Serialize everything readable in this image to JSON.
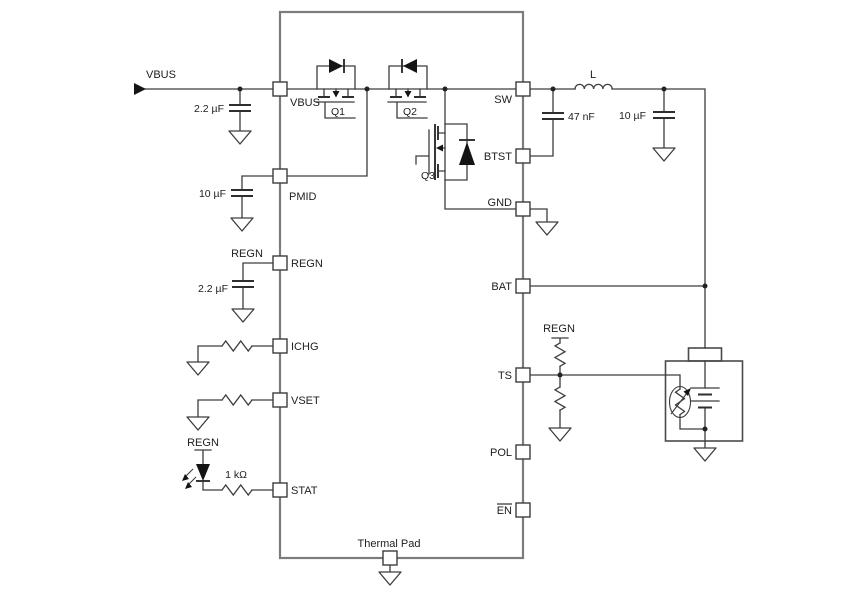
{
  "diagram": {
    "kind": "battery-charger-ic-application-schematic",
    "input_net": "VBUS",
    "regn_net": "REGN",
    "ic": {
      "left_pins": [
        "VBUS",
        "PMID",
        "REGN",
        "ICHG",
        "VSET",
        "STAT"
      ],
      "right_pins": [
        "SW",
        "BTST",
        "GND",
        "BAT",
        "TS",
        "POL",
        "EN"
      ],
      "bottom_pin": "Thermal Pad",
      "transistors": [
        "Q1",
        "Q2",
        "Q3"
      ]
    },
    "components": {
      "c_vbus": "2.2 µF",
      "c_pmid": "10 µF",
      "c_regn": "2.2 µF",
      "r_stat": "1 kΩ",
      "inductor": "L",
      "c_btst": "47 nF",
      "c_out": "10 µF"
    },
    "colors": {
      "wire": "#3d3d3d",
      "ic_outline": "#7c7c7c",
      "fill": "#141414",
      "background": "#ffffff"
    }
  }
}
